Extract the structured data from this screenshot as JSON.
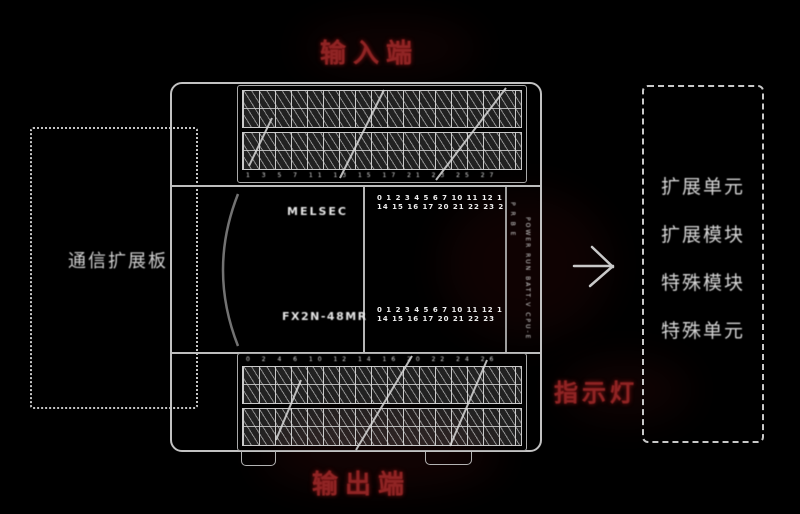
{
  "labels": {
    "input": "输入端",
    "output": "输出端",
    "indicator": "指示灯"
  },
  "left_box": {
    "text": "通信扩展板"
  },
  "right_box": {
    "items": [
      "扩展单元",
      "扩展模块",
      "特殊模块",
      "特殊单元"
    ]
  },
  "plc": {
    "brand_text": "MELSEC",
    "model_text": "FX2N-48MR",
    "input_leds": {
      "row1": "0 1 2 3 4 5 6 7 10 11 12 13",
      "row2": "14 15 16 17 20 21 22 23 24"
    },
    "output_leds": {
      "row1": "0 1 2 3 4 5 6 7 10 11 12 13",
      "row2": "14 15 16 17 20 21 22 23"
    },
    "status_col_a": "P R B E",
    "status_col_b": "POWER RUN BATT.V CPU-E",
    "input_strip_sublabels": "1 3 5 7 11 13 15 17 21 23 25 27",
    "output_strip_sublabels": "0 2 4 6 10 12 14 16 20 22 24 26"
  },
  "colors": {
    "background": "#000000",
    "line": "#c8c8c8",
    "accent_red": "#8f2424",
    "text": "#d6d6d6"
  }
}
